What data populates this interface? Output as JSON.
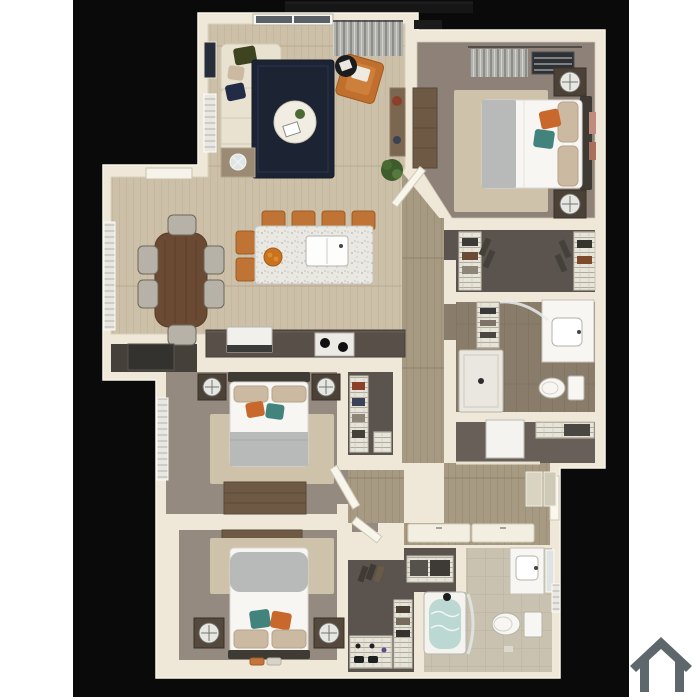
{
  "meta": {
    "description": "3D top-down rendering of a three-bedroom, two-bathroom apartment floor plan on a black background with a gray house logo at the bottom right"
  },
  "colors": {
    "page_bg": "#ffffff",
    "canvas": "#0a0a0a",
    "balcony": "#161616",
    "wall": "#efe8d8",
    "wall_edge": "#f8f4e9",
    "floor_wood": "#cdc0a8",
    "floor_hall": "#a79a82",
    "carpet": "#948a80",
    "carpet_master": "#8d8178",
    "closet_floor": "#5b534d",
    "bath_floor": "#8a7c6b",
    "bath2_floor": "#cac2b1",
    "linen_floor": "#675f58",
    "pantry_floor": "#45403a",
    "rug_navy": "#1c2434",
    "rug_cream": "#cfc2ab",
    "sofa": "#e9e2d1",
    "pillow_green": "#3e441f",
    "pillow_navy": "#222c47",
    "pillow_tan": "#cbb9a2",
    "accent_orange": "#c9682c",
    "accent_teal": "#42837d",
    "chair_orange": "#c06f2d",
    "stool": "#bf7334",
    "wood_table": "#6b4a33",
    "dresser": "#6e5a44",
    "nightstand": "#4c4136",
    "counter": "#574f48",
    "fixture_white": "#f7f6f2",
    "blanket_gray": "#b7bab9",
    "headboard": "#3e3a34",
    "plant": "#4a6a33",
    "water": "#bcd8d2",
    "chair_gray": "#b7b2a8",
    "icon": "#5d676c"
  },
  "rooms": [
    {
      "id": "living-room",
      "furniture": [
        "sectional-sofa",
        "navy-rug",
        "round-coffee-table",
        "leather-accent-chair",
        "black-side-table",
        "glass-side-table",
        "media-console",
        "potted-plant",
        "curtained-window",
        "picture-frames"
      ]
    },
    {
      "id": "dining-area",
      "furniture": [
        "dining-table",
        "dining-chairs-x6",
        "blinds-window"
      ]
    },
    {
      "id": "kitchen",
      "furniture": [
        "granite-island",
        "undermount-sink",
        "bar-stools-x6",
        "fruit-bowl",
        "range-with-burners",
        "white-appliance",
        "dark-counter"
      ]
    },
    {
      "id": "pantry",
      "furniture": [
        "refrigerator"
      ]
    },
    {
      "id": "primary-bedroom",
      "furniture": [
        "queen-bed",
        "nightstands-x2",
        "round-lamps",
        "tall-dresser",
        "cream-rug",
        "window-blinds",
        "wall-art"
      ]
    },
    {
      "id": "primary-walk-in-closet",
      "furniture": [
        "wire-shelving",
        "hanging-clothes"
      ]
    },
    {
      "id": "primary-bathroom",
      "furniture": [
        "walk-in-shower",
        "glass-shower-door",
        "toilet",
        "vanity-sink",
        "linen-shelves"
      ]
    },
    {
      "id": "utility-room",
      "furniture": [
        "water-heater",
        "wire-shelf"
      ]
    },
    {
      "id": "hallway",
      "furniture": [
        "sliding-closet-doors",
        "door-mats"
      ]
    },
    {
      "id": "entry",
      "furniture": [
        "front-door"
      ]
    },
    {
      "id": "bedroom-2",
      "furniture": [
        "queen-bed",
        "nightstands-x2",
        "round-lamps",
        "dresser",
        "cream-rug",
        "blinds-window",
        "door"
      ]
    },
    {
      "id": "bedroom-2-closet",
      "furniture": [
        "wire-shelving",
        "hanging-clothes"
      ]
    },
    {
      "id": "bedroom-3",
      "furniture": [
        "queen-bed",
        "nightstands-x2",
        "round-lamps",
        "dresser",
        "cream-rug",
        "slippers",
        "door"
      ]
    },
    {
      "id": "bedroom-3-closet",
      "furniture": [
        "wire-shelving",
        "shoes"
      ]
    },
    {
      "id": "bathroom-2",
      "furniture": [
        "bathtub-shower",
        "glass-door",
        "toilet",
        "vanity-sink",
        "mirror",
        "window"
      ]
    },
    {
      "id": "linen-closet",
      "furniture": [
        "wire-shelf",
        "baskets"
      ]
    },
    {
      "id": "balcony",
      "furniture": []
    }
  ],
  "icon": {
    "name": "house-icon",
    "color": "#5d676c"
  }
}
